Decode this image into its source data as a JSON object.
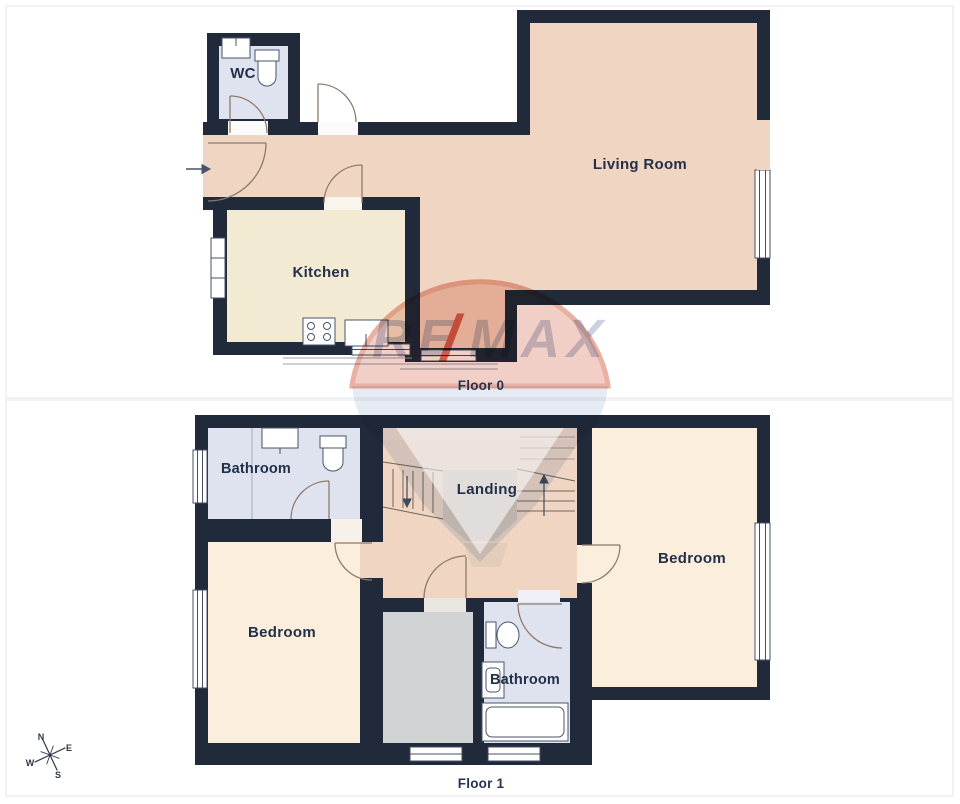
{
  "page": {
    "background": "#ffffff",
    "panel_border": "#e9eaef"
  },
  "colors": {
    "wall": "#212a3a",
    "floor_peach": "#f0d5c3",
    "floor_kitchen": "#f2ead2",
    "floor_bedroom": "#fceedd",
    "floor_bath": "#dfe3ef",
    "floor_grey": "#d2d3d5",
    "landing_platform": "#d6c6b7",
    "door_line": "#8d7a6a",
    "label": "#22304a",
    "watermark_red": "#f2cfc6",
    "watermark_blue": "#e4eaf3"
  },
  "floor0": {
    "label": "Floor 0",
    "rooms": {
      "wc": "WC",
      "kitchen": "Kitchen",
      "living_room": "Living Room"
    }
  },
  "floor1": {
    "label": "Floor 1",
    "rooms": {
      "bathroom_top": "Bathroom",
      "landing": "Landing",
      "bedroom_right": "Bedroom",
      "bedroom_left": "Bedroom",
      "bathroom_bottom": "Bathroom"
    }
  },
  "compass": {
    "n": "N",
    "e": "E",
    "s": "S",
    "w": "W"
  },
  "watermark": {
    "re": "RE",
    "slash": "/",
    "max": "MAX"
  }
}
